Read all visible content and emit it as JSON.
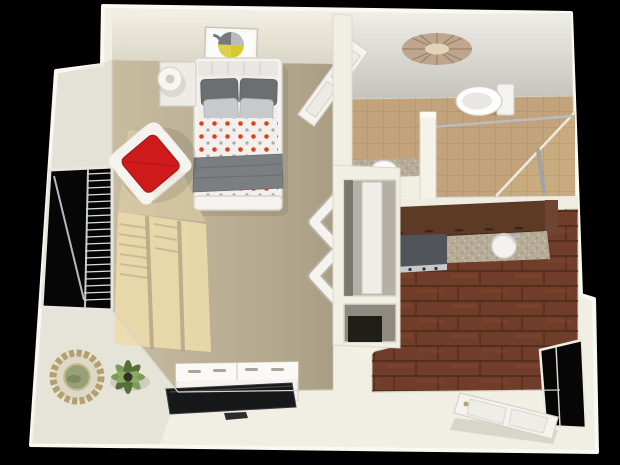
{
  "scene": {
    "type": "3d-floorplan-render",
    "view": "top-down perspective",
    "subject": "studio apartment floor plan",
    "width_px": 620,
    "height_px": 465
  },
  "colors": {
    "background": "#000000",
    "wall": "#f1eee3",
    "wall_bright": "#faf8f1",
    "carpet": "#c7bba0",
    "sun_patch": "#eddcab",
    "tile_floor": "#c2a37b",
    "shower_tile": "#c9ab80",
    "wood_floor": "#6f3d29",
    "cabinet_brown": "#5d3a26",
    "granite": "#b5ab97",
    "appliance_gray": "#515458",
    "furniture_white": "#f4f3ef",
    "pillow_dark": "#6c6f72",
    "pillow_light": "#c8c9cb",
    "duvet_base": "#f2efec",
    "duvet_dot": "#d8441e",
    "blanket_gray": "#7c7f82",
    "accent_red": "#ce1a1a",
    "art_yellow": "#d6ca2a",
    "art_gray": "#767a7d",
    "mirror_gold": "#b3a06e",
    "plant_green": "#7a9c55",
    "plant_dark": "#566e3a",
    "ceiling_gray": "#d4d1cb",
    "medallion": "#bda289",
    "opening_black": "#060606",
    "chrome": "#b9bcbf",
    "tv_black": "#17181a"
  },
  "rooms": [
    {
      "id": "main-room",
      "label": "Bedroom / Living Area",
      "floor": "beige carpet",
      "items": [
        "bed with orange dot duvet and gray pillows",
        "framed geometric wall art",
        "nightstand with table lamp",
        "white armchair with red throw pillow",
        "window with open blinds",
        "sunlight patch on carpet",
        "bifold closet doors",
        "sunburst wall mirror",
        "potted plant",
        "white dresser with flat-screen TV"
      ]
    },
    {
      "id": "bathroom",
      "label": "Bathroom",
      "floor": "tan tile",
      "items": [
        "open paneled door",
        "toilet",
        "vanity sink",
        "half wall",
        "walk-in shower with grab bar",
        "shower rod",
        "decorative ceiling medallion"
      ]
    },
    {
      "id": "kitchen",
      "label": "Kitchen",
      "floor": "dark wood planks",
      "items": [
        "brown upper cabinets",
        "refrigerator",
        "granite countertop",
        "round sink"
      ]
    },
    {
      "id": "entry",
      "label": "Entry",
      "floor": "wood / threshold",
      "items": [
        "open front door",
        "dark doorway opening"
      ]
    }
  ],
  "lighting": {
    "sunlight_source": "left window",
    "shadow_grid": "window mullion shadows on carpet"
  }
}
